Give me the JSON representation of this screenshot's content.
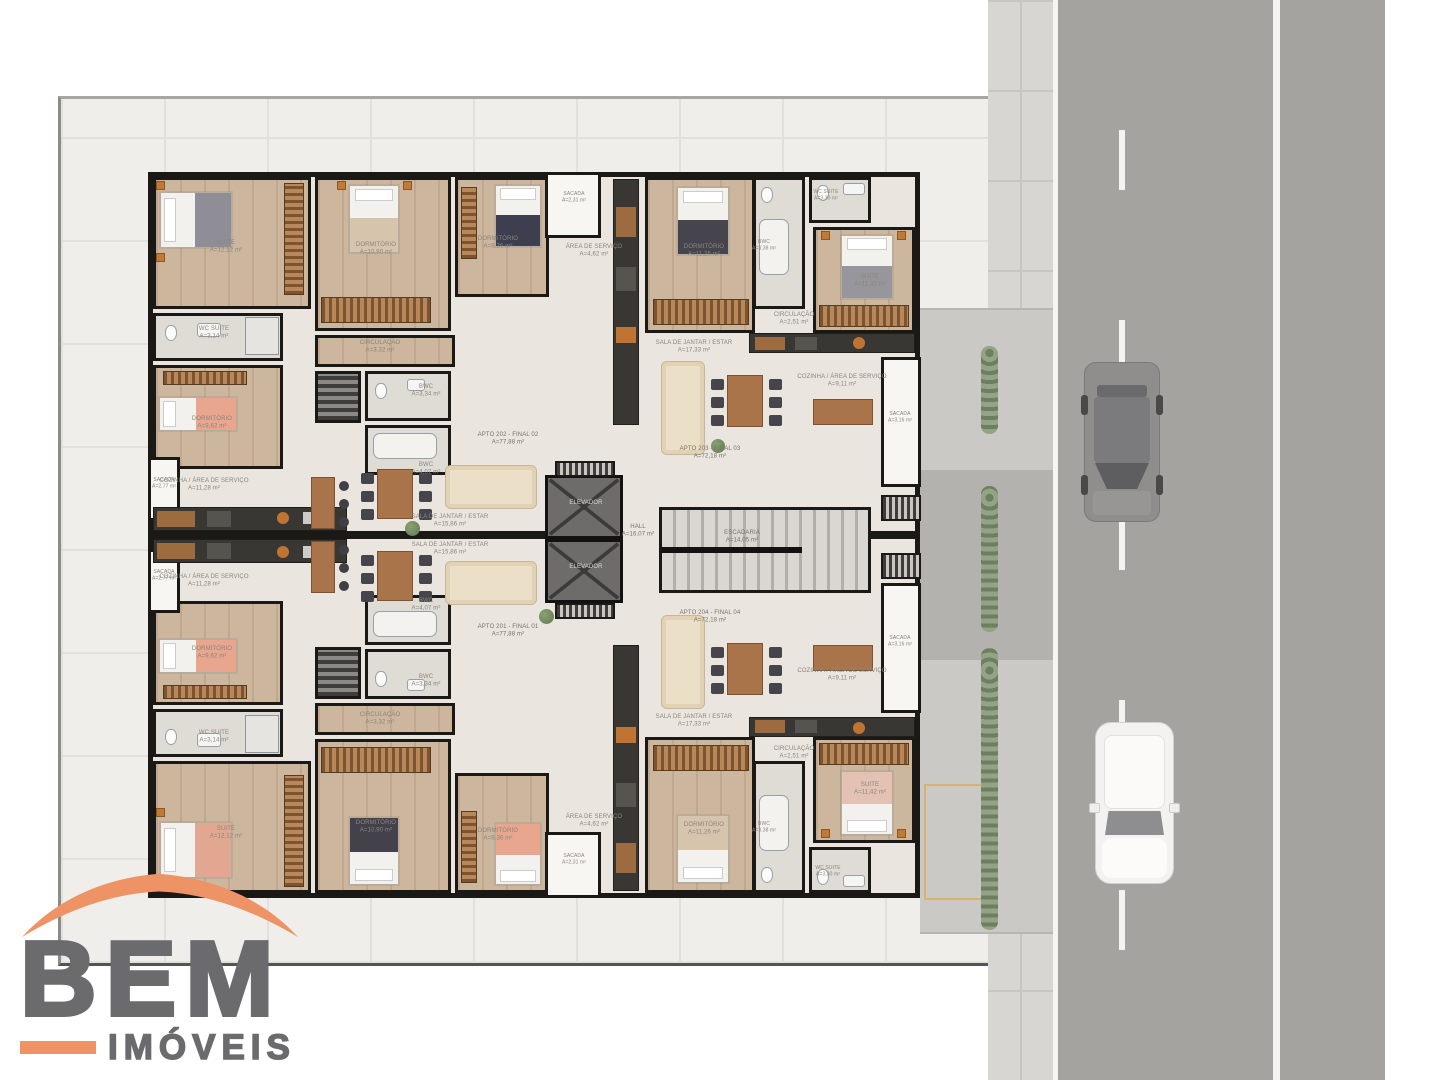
{
  "branding": {
    "name_main": "BEM",
    "name_sub": "IMÓVEIS"
  },
  "colors": {
    "accent_orange": "#EE9365",
    "logo_gray": "#6B6B6E",
    "wall_black": "#1B1916",
    "wood_floor": "#CDB69E",
    "wet_floor": "#DFDBD5",
    "open_floor": "#EAE5DE",
    "lot_paving": "#EFEEEB",
    "road_gray": "#A5A3A0",
    "sidewalk_gray": "#D8D6D2",
    "hedge_green": "#8A9A7C",
    "elevator_gray": "#6E6C6A"
  },
  "plan": {
    "core": {
      "hall": "HALL\nA=16,07 m²",
      "stairs": "ESCADARIA\nA=14,05 m²",
      "elevator1": "ELEVADOR",
      "elevator2": "ELEVADOR"
    },
    "balconies": {
      "top": "SACADA\nA=2,31 m²",
      "bottom": "SACADA\nA=2,31 m²",
      "left_top": "SACADA\nA=2,77 m²",
      "left_bottom": "SACADA\nA=2,77 m²",
      "right_top": "SACADA\nA=3,16 m²",
      "right_bottom": "SACADA\nA=3,16 m²"
    },
    "apt_tl": {
      "unit": "APTO 202 - FINAL 02\nA=77,88 m²",
      "suite": "SUITE\nA=12,12 m²",
      "dorm1": "DORMITÓRIO\nA=10,90 m²",
      "dorm2": "DORMITÓRIO\nA=9,36 m²",
      "dorm3": "DORMITÓRIO\nA=9,62 m²",
      "wc_suite": "WC SUITE\nA=3,14 m²",
      "circ": "CIRCULAÇÃO\nA=3,32 m²",
      "bwc1": "BWC\nA=3,34 m²",
      "bwc2": "BWC\nA=4,07 m²",
      "cozinha": "COZINHA / ÁREA DE SERVIÇO\nA=11,28 m²",
      "servico": "ÁREA DE SERVIÇO\nA=4,62 m²",
      "sala": "SALA DE JANTAR / ESTAR\nA=15,86 m²"
    },
    "apt_tr": {
      "unit": "APTO 203 - FINAL 03\nA=72,18 m²",
      "suite": "SUITE\nA=11,42 m²",
      "dorm": "DORMITÓRIO\nA=11,26 m²",
      "wc_suite": "WC SUITE\nA=3,30 m²",
      "wc": "BWC\nA=3,38 m²",
      "circ": "CIRCULAÇÃO\nA=2,51 m²",
      "cozinha": "COZINHA / ÁREA DE SERVIÇO\nA=9,11 m²",
      "sala": "SALA DE JANTAR / ESTAR\nA=17,33 m²"
    },
    "apt_bl": {
      "unit": "APTO 201 - FINAL 01\nA=77,88 m²",
      "suite": "SUITE\nA=12,12 m²",
      "dorm1": "DORMITÓRIO\nA=10,90 m²",
      "dorm2": "DORMITÓRIO\nA=9,36 m²",
      "dorm3": "DORMITÓRIO\nA=9,62 m²",
      "wc_suite": "WC SUITE\nA=3,14 m²",
      "circ": "CIRCULAÇÃO\nA=3,32 m²",
      "bwc1": "BWC\nA=3,34 m²",
      "bwc2": "BWC\nA=4,07 m²",
      "cozinha": "COZINHA / ÁREA DE SERVIÇO\nA=11,28 m²",
      "servico": "ÁREA DE SERVIÇO\nA=4,62 m²",
      "sala": "SALA DE JANTAR / ESTAR\nA=15,86 m²"
    },
    "apt_br": {
      "unit": "APTO 204 - FINAL 04\nA=72,18 m²",
      "suite": "SUITE\nA=11,42 m²",
      "dorm": "DORMITÓRIO\nA=11,26 m²",
      "wc_suite": "WC SUITE\nA=3,30 m²",
      "wc": "BWC\nA=3,38 m²",
      "circ": "CIRCULAÇÃO\nA=2,51 m²",
      "cozinha": "COZINHA / ÁREA DE SERVIÇO\nA=9,11 m²",
      "sala": "SALA DE JANTAR / ESTAR\nA=17,33 m²"
    }
  }
}
